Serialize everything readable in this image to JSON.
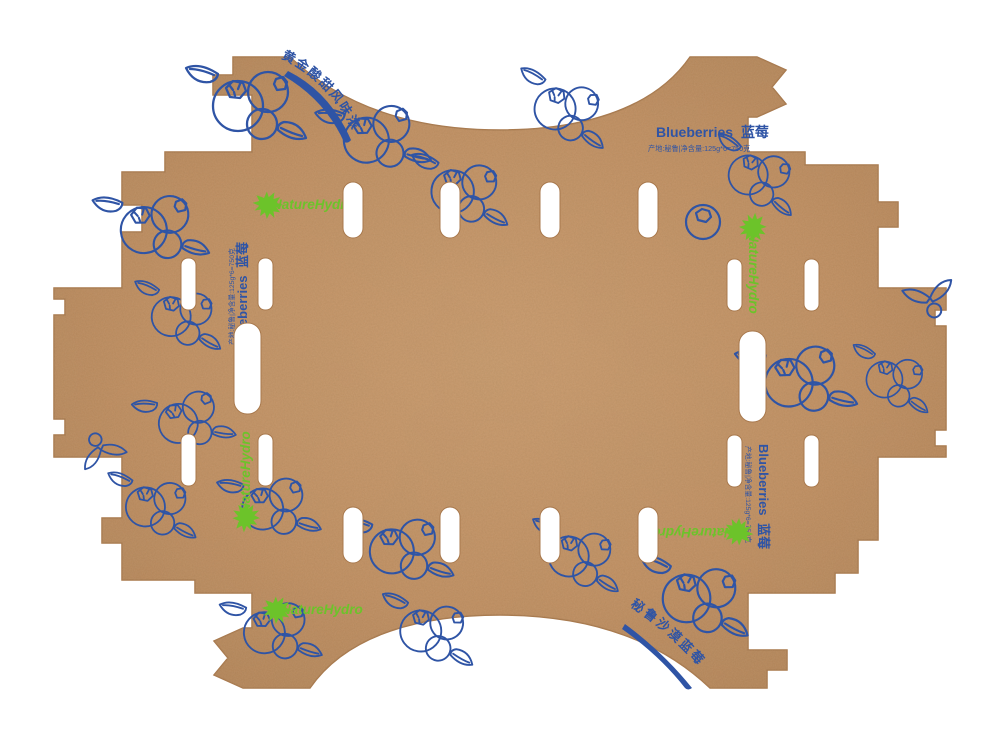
{
  "document": {
    "kind": "blueberry packaging dieline on kraft board",
    "background": "#ffffff"
  },
  "labels": {
    "product_en": "Blueberries",
    "product_zh": "蓝莓",
    "origin_net_weight": "产地:秘鲁|净含量:125g*6=750克",
    "slogan_top_left": "黄金酸甜风味浓",
    "slogan_bottom_right": "秘鲁沙漠蓝莓",
    "brand": "NatureHydro"
  },
  "icons": {
    "brand": "leaf-burst-icon",
    "decoration": "blueberry-cluster-illustration"
  },
  "counts": {
    "brand_logo_instances": 5,
    "product_label_instances": 3,
    "punched_slots": 18
  },
  "colors": {
    "kraft_base": "#bf8c5e",
    "kraft_light": "#c9996b",
    "kraft_dark": "#a97a4e",
    "ink_blue": "#2f54a5",
    "logo_green": "#6cc32a",
    "background": "#ffffff"
  }
}
